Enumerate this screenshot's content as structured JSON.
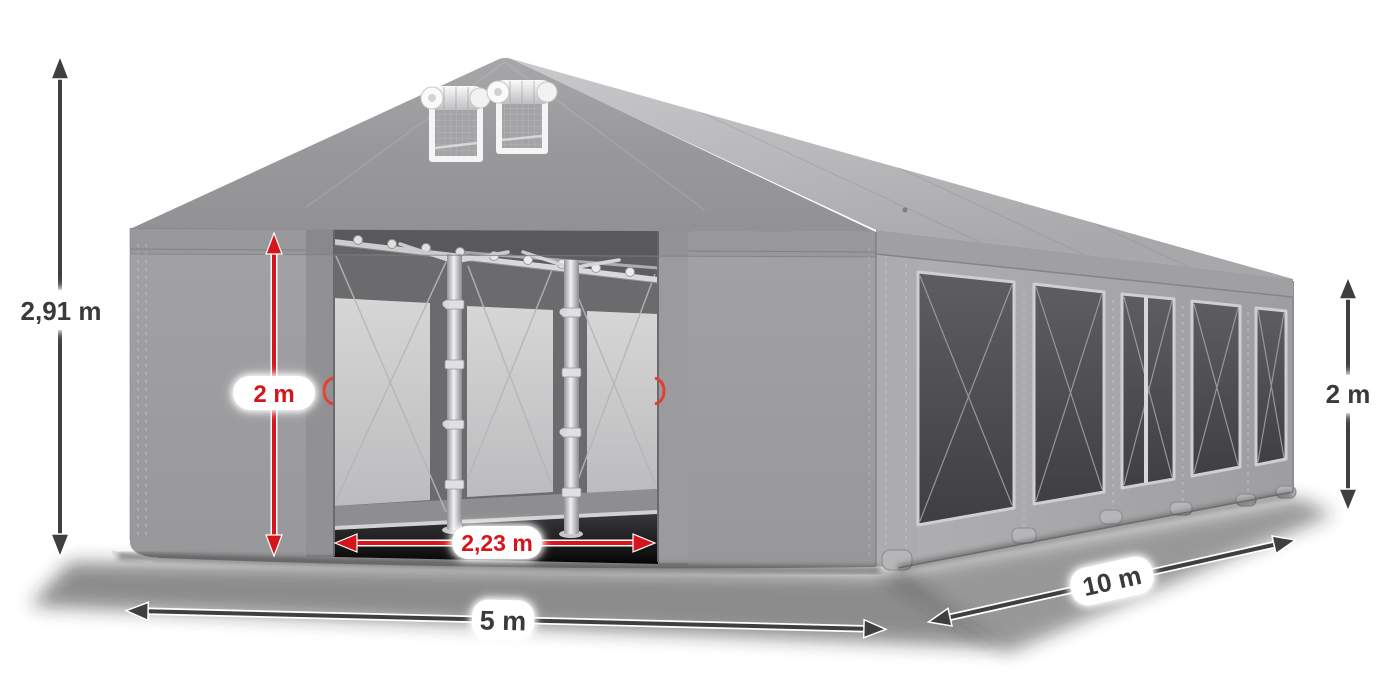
{
  "labels": {
    "total_height": "2,91 m",
    "door_height": "2 m",
    "door_width": "2,23 m",
    "front_width": "5 m",
    "side_length": "10 m",
    "wall_height": "2 m"
  },
  "colors": {
    "accent_red": "#d4161c",
    "arrow_dark": "#3f3f41",
    "label_text_dark": "#3a3a3c",
    "tent_gable": "#98989a",
    "tent_roof": "#b8b8ba",
    "tent_side_wall": "#a6a6a8",
    "window_dark": "#4a4a4c",
    "background": "#ffffff"
  }
}
